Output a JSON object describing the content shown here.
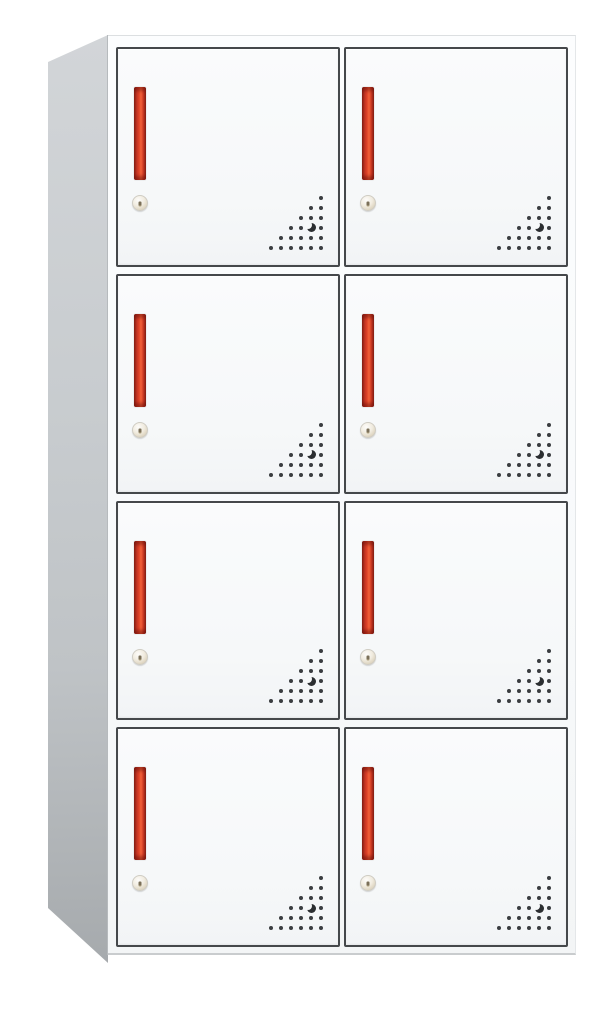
{
  "product": {
    "name": "metal-locker-cabinet",
    "rows": 4,
    "columns": 2,
    "door_count": 8
  },
  "door_parts": {
    "handle": "red-vertical-recessed-handle",
    "lock": "round-cam-lock-with-keyhole",
    "vent": "triangular-perforation-pattern"
  },
  "vent": {
    "rows": [
      1,
      2,
      3,
      4,
      5,
      6
    ],
    "crescent": {
      "row_index": 3,
      "offset_from_right": 1
    }
  },
  "colors": {
    "background": "#FFFFFF",
    "frame_white": "#FCFDFE",
    "door_face": "#F6F8F9",
    "door_border": "#45484B",
    "side_panel_top": "#D2D5D8",
    "side_panel_bottom": "#A6AAAD",
    "handle_dark": "#9A281B",
    "handle_mid": "#D93E26",
    "handle_bright": "#F26038",
    "lock_body": "#DCD3BE",
    "vent_dot": "#3A3D40"
  }
}
